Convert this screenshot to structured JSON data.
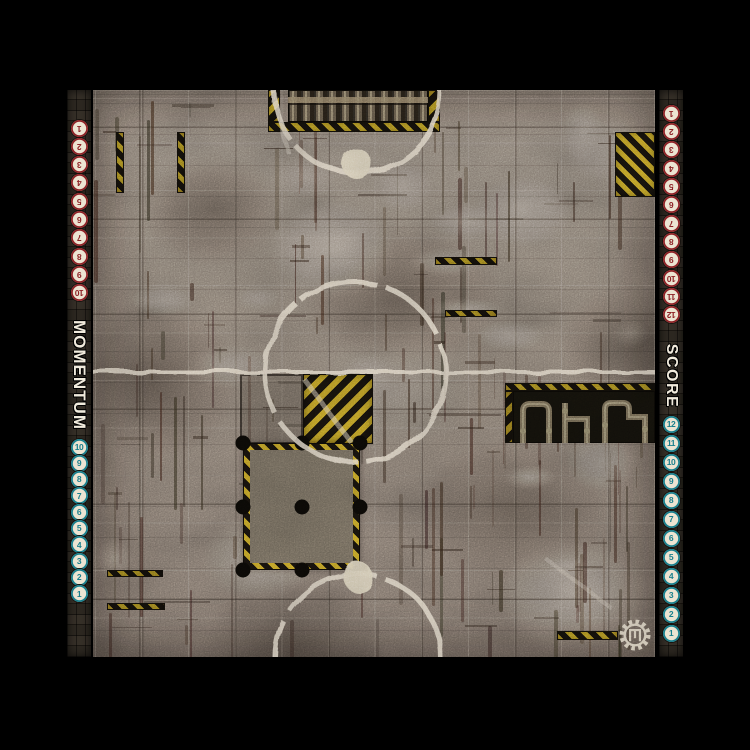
{
  "tracks": {
    "momentum": {
      "label": "MOMENTUM",
      "red_numbers": [
        "1",
        "2",
        "3",
        "4",
        "5",
        "6",
        "7",
        "8",
        "9",
        "10"
      ],
      "teal_numbers": [
        "10",
        "9",
        "8",
        "7",
        "6",
        "5",
        "4",
        "3",
        "2",
        "1"
      ]
    },
    "score": {
      "label": "SCORE",
      "red_numbers": [
        "1",
        "2",
        "3",
        "4",
        "5",
        "6",
        "7",
        "8",
        "9",
        "10",
        "11",
        "12"
      ],
      "teal_numbers": [
        "12",
        "11",
        "10",
        "9",
        "8",
        "7",
        "6",
        "5",
        "4",
        "3",
        "2",
        "1"
      ]
    }
  },
  "colors": {
    "track_red": "#8e2226",
    "track_teal": "#187f8d",
    "hazard_yellow": "#bf9d26",
    "field_paint": "#e8decc"
  },
  "icons": {
    "logo": "gear-logo"
  }
}
